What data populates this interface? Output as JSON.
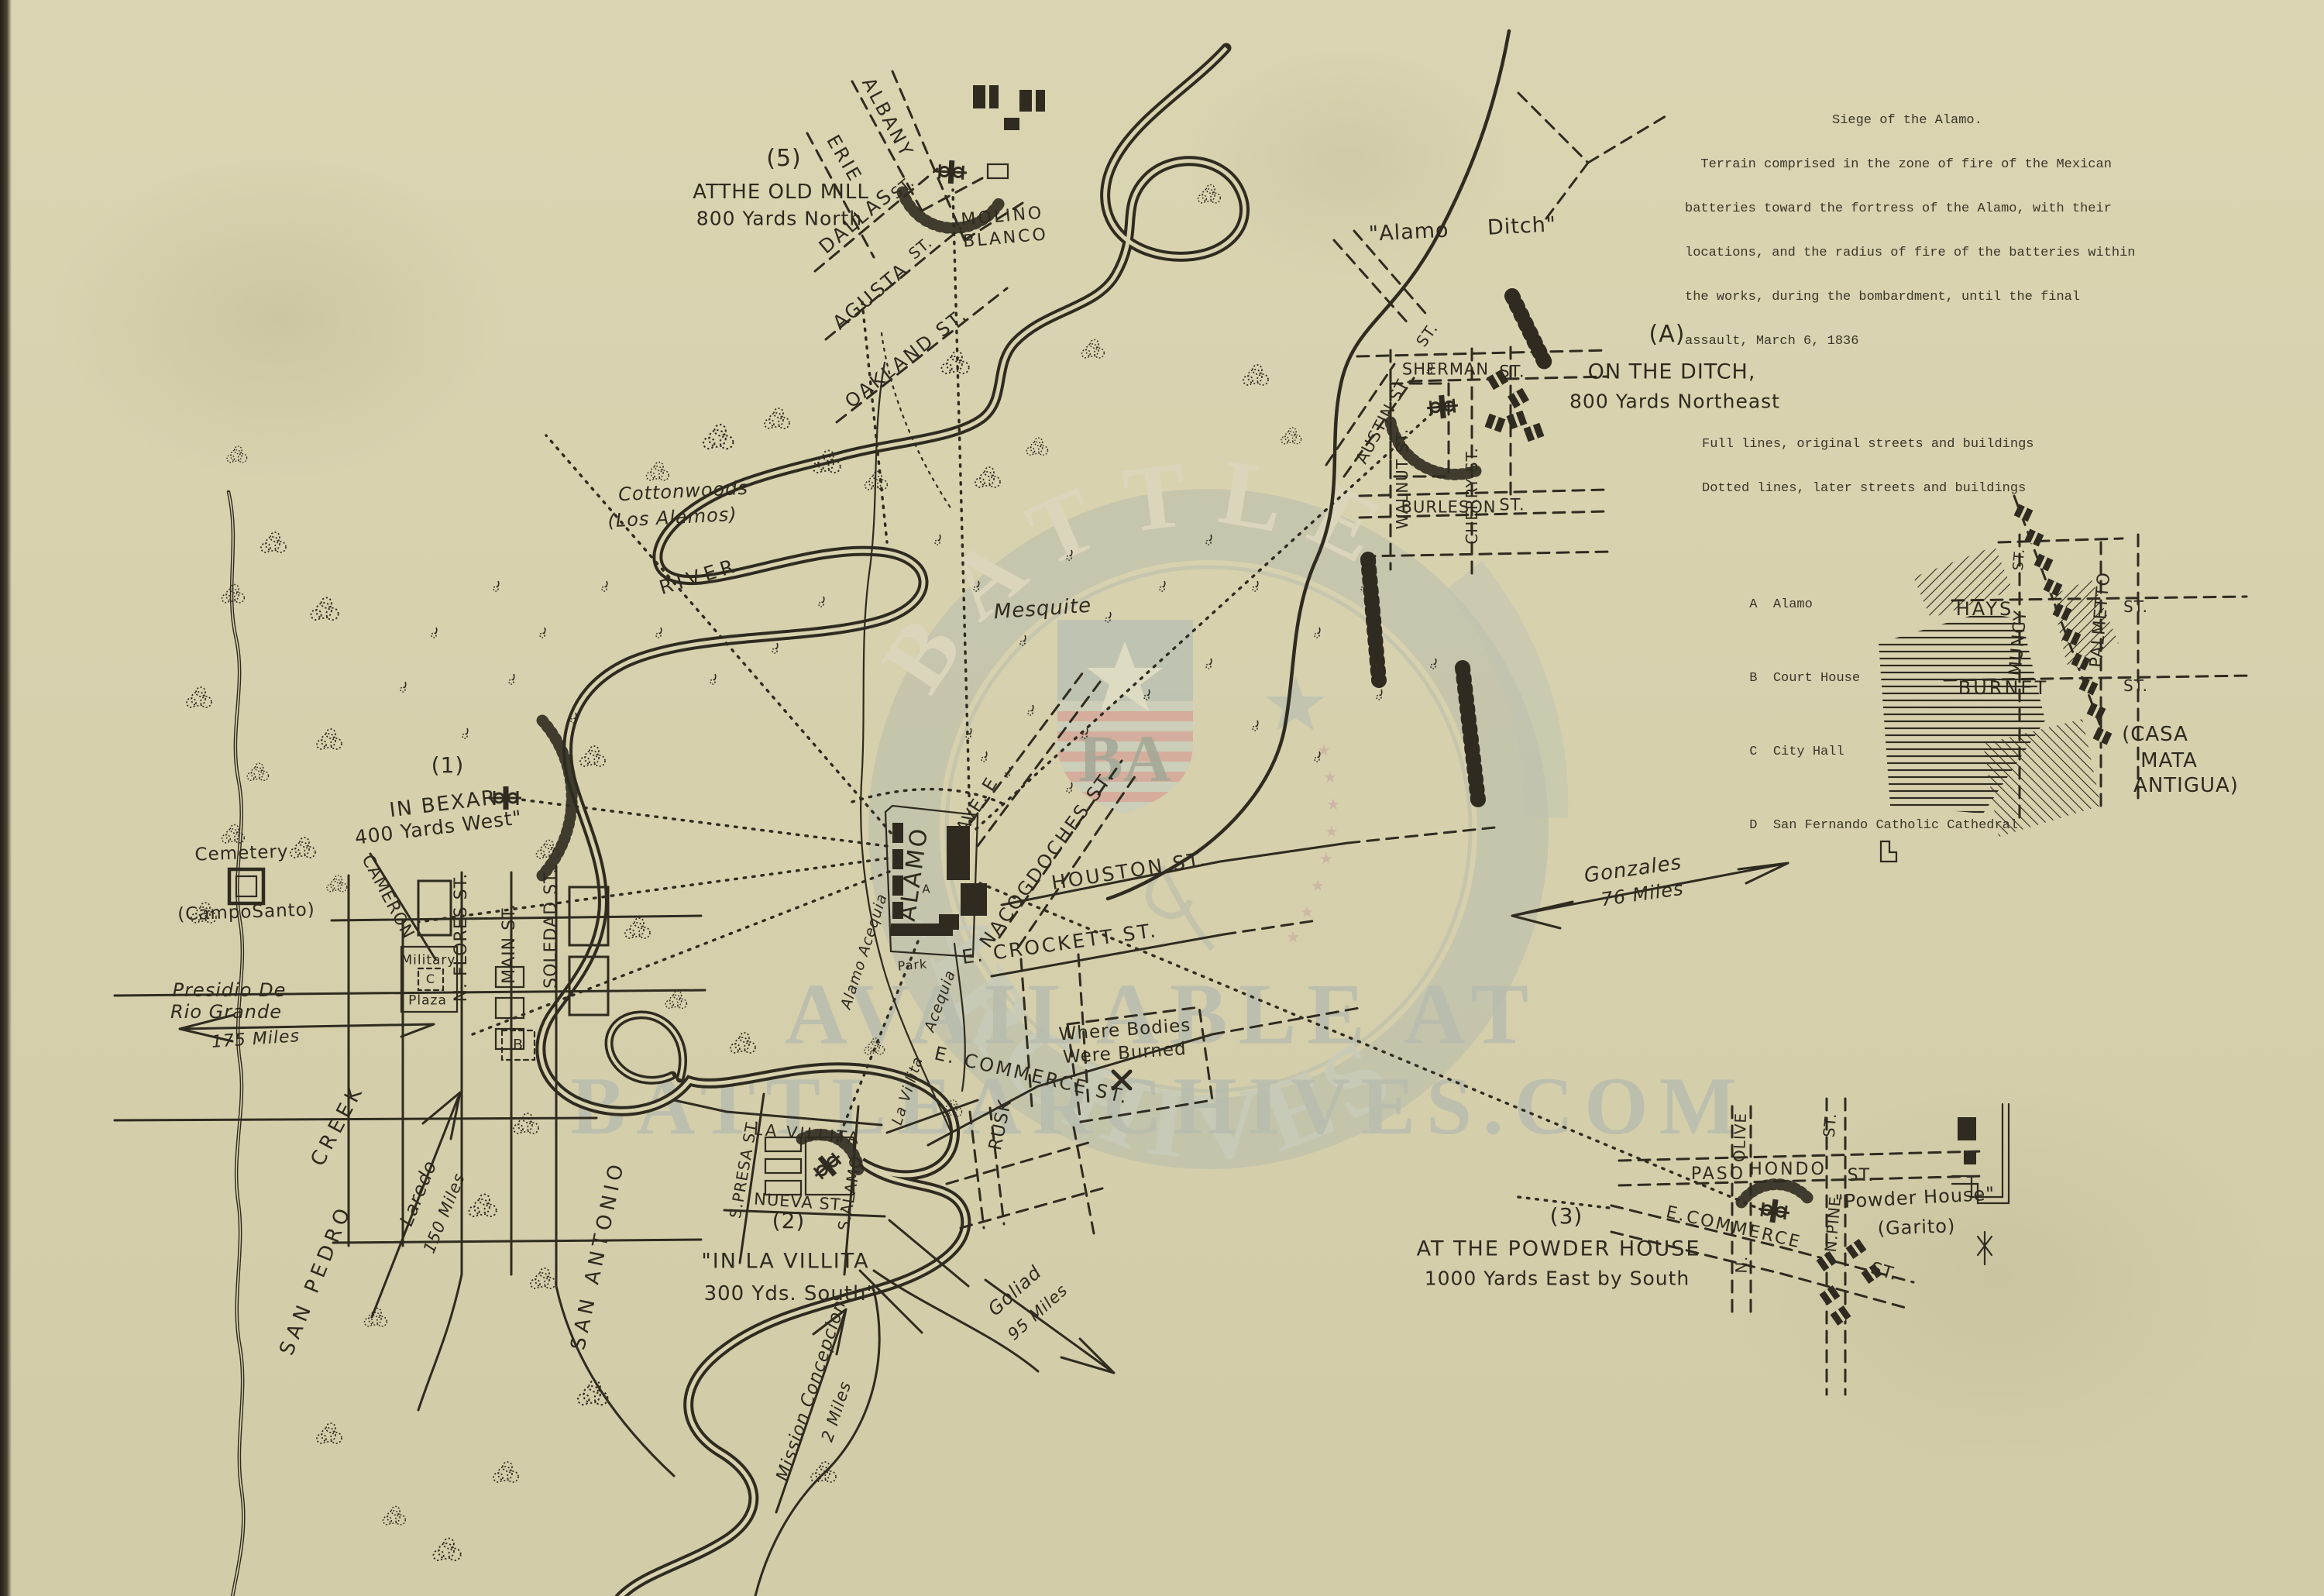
{
  "title_block": {
    "title": "Siege of the Alamo.",
    "body_lines": [
      "  Terrain comprised in the zone of fire of the Mexican",
      "batteries toward the fortress of the Alamo, with their",
      "locations, and the radius of fire of the batteries within",
      "the works, during the bombardment, until the final",
      "assault, March 6, 1836"
    ],
    "legend_full": "Full lines, original streets and buildings",
    "legend_dotted": "Dotted lines, later streets and buildings",
    "key": [
      {
        "letter": "A",
        "name": "Alamo"
      },
      {
        "letter": "B",
        "name": "Court House"
      },
      {
        "letter": "C",
        "name": "City Hall"
      },
      {
        "letter": "D",
        "name": "San Fernando Catholic Cathedral"
      }
    ]
  },
  "batteries": [
    {
      "id": "(1)",
      "line1": "IN BEXAR",
      "line2": "400 Yards West\""
    },
    {
      "id": "(2)",
      "line1": "\"IN LA VILLITA",
      "line2": "300 Yds. South\""
    },
    {
      "id": "(3)",
      "line1": "AT THE POWDER HOUSE",
      "line2": "1000 Yards East by South"
    },
    {
      "id": "(A)",
      "line1": "ON THE DITCH,",
      "line2": "800 Yards Northeast"
    },
    {
      "id": "(5)",
      "line1": "ATTHE OLD MILL",
      "line2": "800 Yards North"
    }
  ],
  "map": {
    "albany": "ALBANY",
    "erie": "ERIE",
    "dallas": "DALLAS",
    "dallas_st": "ST.",
    "agusta": "AGUSTA",
    "agusta_st": "ST.",
    "oakland": "OAKLAND ST.",
    "molino1": "MOLINO",
    "molino2": "BLANCO",
    "alamo_ditch": "\"Alamo  Ditch\"",
    "st_diag": "ST.",
    "sherman": "SHERMAN",
    "sherman_st": "ST.",
    "austin": "AUSTIN ST.",
    "walnut": "WALNUT ST.",
    "cherry": "CHERRY ST.",
    "burleson": "BURLESON",
    "burleson_st": "ST.",
    "hays": "HAYS",
    "hays_st": "ST.",
    "muncy": "MUNCY",
    "muncy_st": "ST.",
    "palmetto": "PALMETTO",
    "burnet": "BURNET",
    "burnet_st": "ST.",
    "casa1": "(CASA",
    "casa2": "MATA",
    "casa3": "ANTIGUA)",
    "cottonwoods1": "Cottonwoods",
    "cottonwoods2": "(Los Alamos)",
    "river": "RIVER",
    "mesquite": "Mesquite",
    "gonzales1": "Gonzales",
    "gonzales2": "76 Miles",
    "san_pedro": "SAN PEDRO",
    "creek": "CREEK",
    "san_antonio": "SAN ANTONIO",
    "cemetery": "Cemetery",
    "campo": "(CampoSanto)",
    "presidio1": "Presidio De",
    "presidio2": "Rio Grande",
    "presidio3": "175 Miles",
    "laredo1": "Laredo",
    "laredo2": "150 Miles",
    "cameron": "CAMERON",
    "nflores": "N. FLORES ST.",
    "main": "MAIN ST.",
    "soledad": "SOLEDAD ST.",
    "military": "Military",
    "mil_c": "C",
    "plaza": "Plaza",
    "marker_b": "B",
    "marker_a": "A",
    "alamo": "ALAMO",
    "alamo_acequia": "Alamo Acequia",
    "acequia": "Acequia",
    "park": "Park",
    "ave_e": "AVE. E",
    "nacogdoches": "NACOGDOCHES ST.",
    "houston": "HOUSTON ST.",
    "crockett": "E. CROCKETT ST.",
    "bodies1": "Where Bodies",
    "bodies2": "Were Burned",
    "ecommerce": "E. COMMERCE ST.",
    "rusk": "RUSK",
    "la_villita_it": "La Villita",
    "lavillita_blk": "LA VILLITA",
    "spresa": "S.PRESA ST.",
    "nueva": "NUEVA ST.",
    "salamo": "S.ALAMO",
    "goliad1": "Goliad",
    "goliad2": "95 Miles",
    "mission1": "Mission Concepcion",
    "mission2": "2 Miles",
    "olive": "OLIVE",
    "olive_n": "N.",
    "paso": "PASO",
    "hondo": "HONDO",
    "paso_st": "ST.",
    "npine": "N.PINE",
    "npine_st": "ST.",
    "ecom_ph": "E.COMMERCE",
    "ecom_ph_st": "ST.",
    "powder1": "\"Powder House\"",
    "powder2": "(Garito)"
  },
  "watermark": {
    "arc_top": "BATTLE",
    "word_bottom": "ARCHIVES",
    "monogram": "BA",
    "available": "AVAILABLE AT",
    "site": "BATTLEARCHIVES.COM"
  },
  "colors": {
    "paper": "#d8d2ae",
    "ink": "#2f2b20",
    "watermark_gray": "#b7bcae",
    "watermark_red": "#d99a8e"
  }
}
